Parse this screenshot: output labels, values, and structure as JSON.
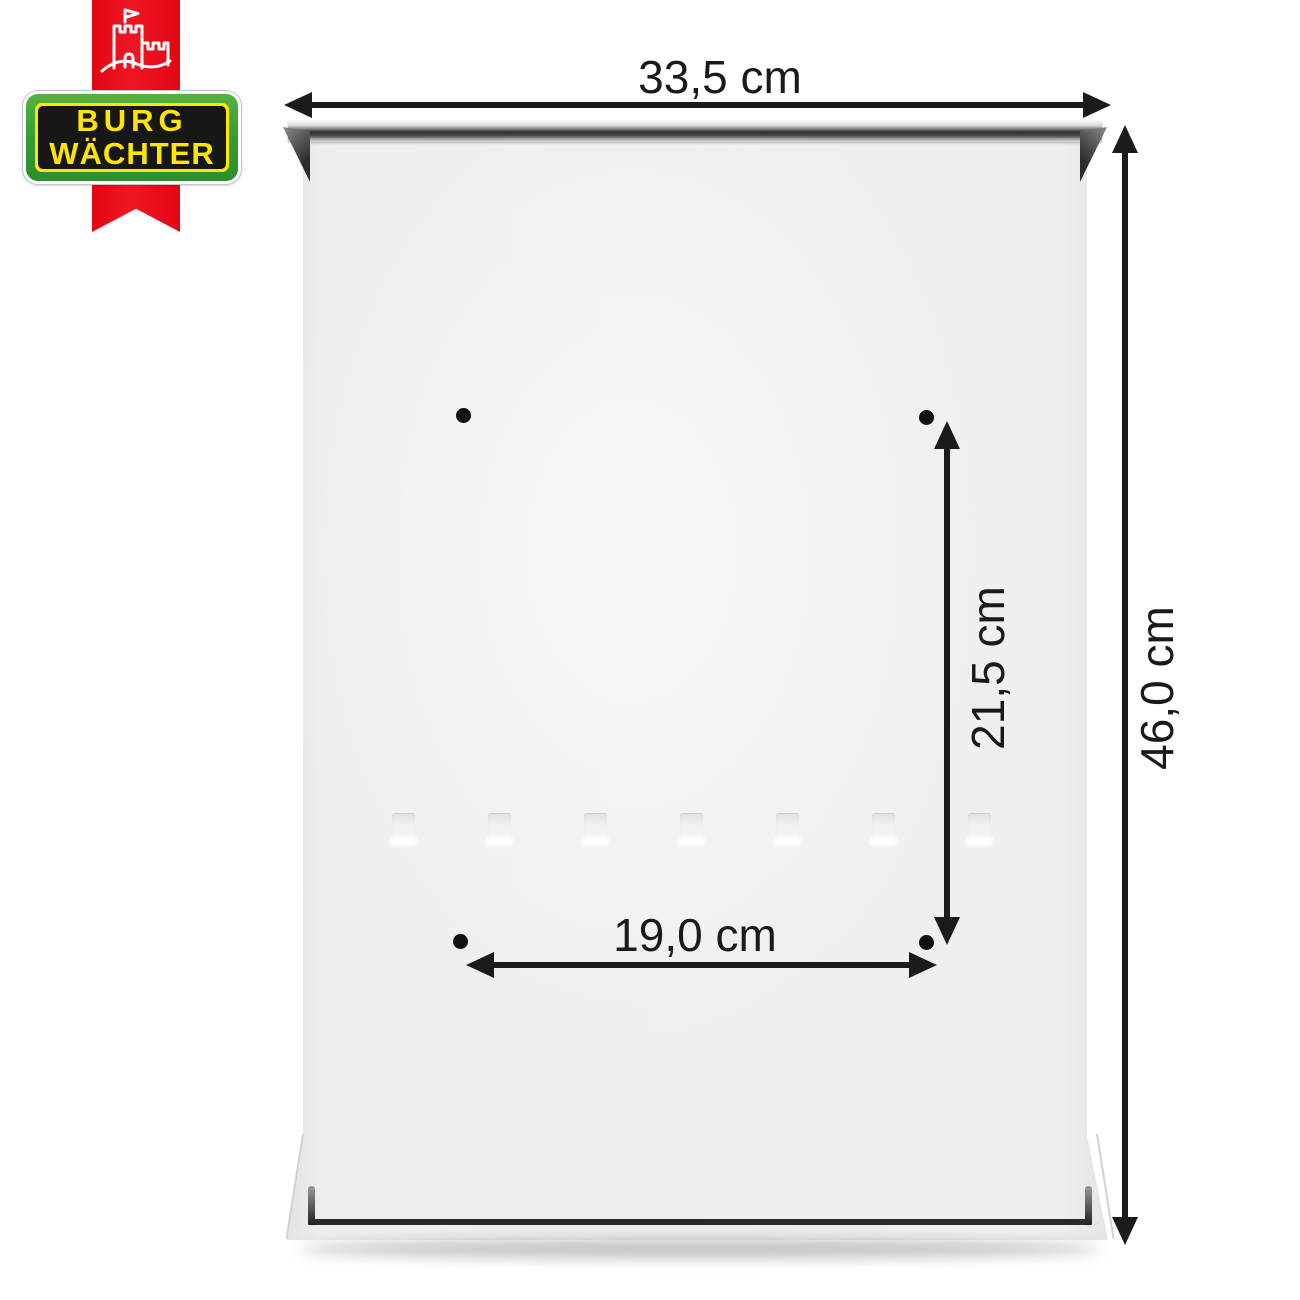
{
  "brand": {
    "name_line1": "BURG",
    "name_line2": "WÄCHTER",
    "castle_icon": "castle-with-flag",
    "colors": {
      "ribbon_red": "#e30613",
      "badge_green": "#339b31",
      "badge_yellow": "#ffe600",
      "badge_black": "#171717"
    }
  },
  "product": {
    "depicted": "mailbox back panel with mounting holes",
    "mounting_holes_count": 4,
    "mounting_slots_count": 7
  },
  "dimensions": {
    "width": {
      "label": "33,5 cm"
    },
    "height": {
      "label": "46,0 cm"
    },
    "hole_spacing_vertical": {
      "label": "21,5 cm"
    },
    "hole_spacing_horizontal": {
      "label": "19,0 cm"
    }
  },
  "annotation_color": "#1b1b1b"
}
